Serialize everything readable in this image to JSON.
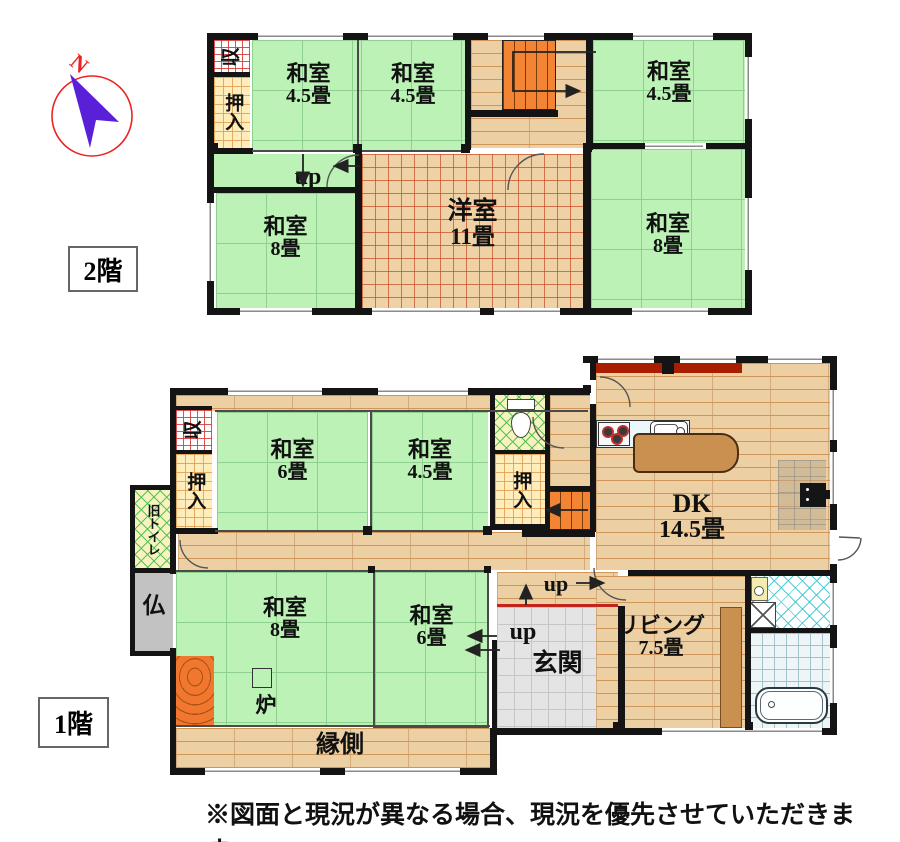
{
  "palette": {
    "tatami_green": "#bdf2b6",
    "wood_floor": "#ecd0a4",
    "carpet_grid": "#c85028",
    "stairs_orange": "#f28433",
    "oshiire_yellow": "#ffeebb",
    "shuno_grid_red": "#d64040",
    "toilet_hatch_green": "#46be46",
    "wash_hatch_cyan": "#3cc8d2",
    "genkan_grey": "#e4e4e4",
    "wall_black": "#141414",
    "deck_red_bar": "#a81f00",
    "tokonoma_orange": "#f2772e",
    "compass_arrow": "#5a1fd8",
    "compass_ring": "#ee2222"
  },
  "compass": {
    "north_label": "N"
  },
  "floor2": {
    "tag": "2階",
    "up_label": "up",
    "rooms": {
      "shuno": "収",
      "oshiire": "押入",
      "washitsu_nw": {
        "name": "和室",
        "size": "4.5畳"
      },
      "washitsu_n": {
        "name": "和室",
        "size": "4.5畳"
      },
      "washitsu_ne": {
        "name": "和室",
        "size": "4.5畳"
      },
      "washitsu_sw": {
        "name": "和室",
        "size": "8畳"
      },
      "yoshitsu": {
        "name": "洋室",
        "size": "11畳"
      },
      "washitsu_se": {
        "name": "和室",
        "size": "8畳"
      }
    }
  },
  "floor1": {
    "tag": "1階",
    "up_label_north": "up",
    "up_label_west": "up",
    "rooms": {
      "shuno": "収",
      "oshiire_west": "押入",
      "old_toilet": "旧トイレ",
      "butsudan": "仏",
      "washitsu_n6": {
        "name": "和室",
        "size": "6畳"
      },
      "washitsu_n45": {
        "name": "和室",
        "size": "4.5畳"
      },
      "oshiire_mid": "押入",
      "washitsu_s8": {
        "name": "和室",
        "size": "8畳"
      },
      "ro": "炉",
      "washitsu_s6": {
        "name": "和室",
        "size": "6畳"
      },
      "engawa": "縁側",
      "genkan": "玄関",
      "dk": {
        "name": "DK",
        "size": "14.5畳"
      },
      "living": {
        "name": "リビング",
        "size": "7.5畳"
      }
    }
  },
  "footer_note": "※図面と現況が異なる場合、現況を優先させていただきます。"
}
